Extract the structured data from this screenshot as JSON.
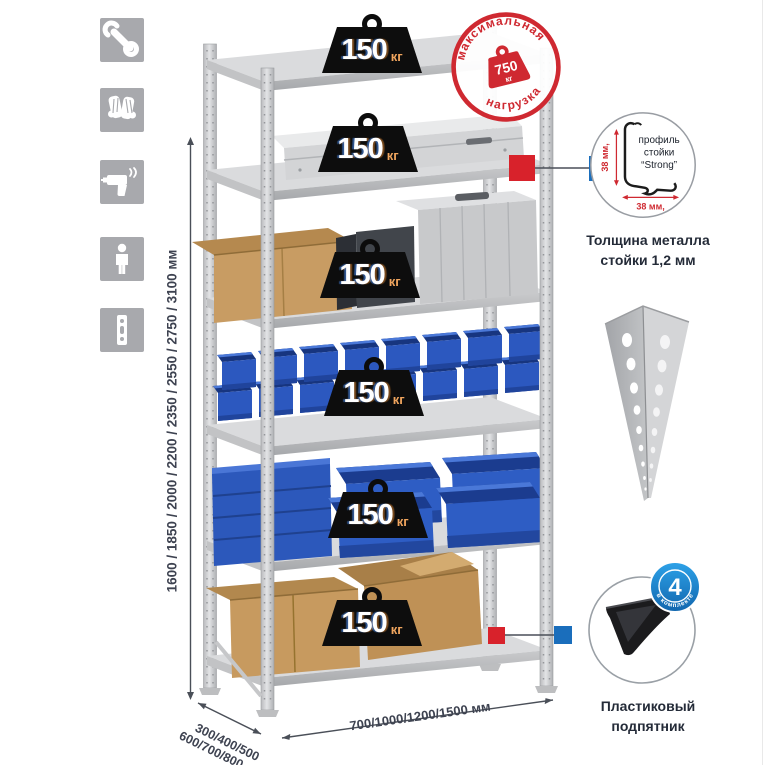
{
  "sidebar": {
    "icons": [
      {
        "name": "wrench"
      },
      {
        "name": "gloves"
      },
      {
        "name": "drill"
      },
      {
        "name": "person"
      },
      {
        "name": "rack-post"
      }
    ]
  },
  "weights": {
    "value": "150",
    "unit": "кг"
  },
  "stamp": {
    "arc_top": "максимальная",
    "arc_bottom": "нагрузка",
    "value": "750",
    "unit": "кг"
  },
  "dimensions": {
    "heights": "1600 / 1850 / 2000 / 2200 / 2350 / 2550 / 2750 / 3100 мм",
    "depth_line1": "300/400/500",
    "depth_line2": "600/700/800 мм",
    "width": "700/1000/1200/1500 мм"
  },
  "profile_detail": {
    "label1": "профиль",
    "label2": "стойки",
    "label3": "“Strong”",
    "dim_vertical": "38 мм,",
    "dim_horizontal": "38 мм,",
    "caption1": "Толщина металла",
    "caption2": "стойки 1,2 мм"
  },
  "foot_detail": {
    "badge_value": "4",
    "badge_arc": "в комплекте",
    "caption1": "Пластиковый",
    "caption2": "подпятник"
  },
  "colors": {
    "stamp_red": "#cf2931",
    "marker_red": "#d8222b",
    "marker_blue": "#1a6ebc",
    "bin_blue": "#2c58bf",
    "icon_gray": "#a8a9ad",
    "metal_gray": "#c9cacc",
    "text_dark": "#3d4250"
  }
}
